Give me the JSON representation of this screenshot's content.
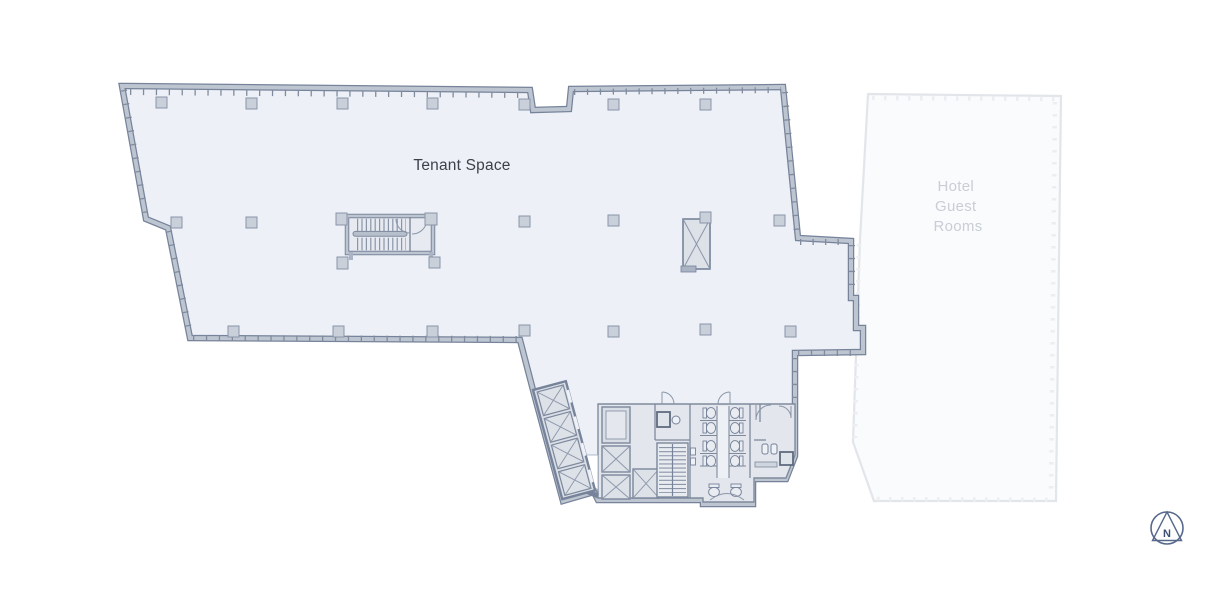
{
  "floorplan": {
    "tenant_area": {
      "label": "Tenant Space"
    },
    "hotel_area": {
      "label_lines": [
        "Hotel",
        "Guest",
        "Rooms"
      ]
    },
    "compass": {
      "letter": "N"
    },
    "features": {
      "central_stair": "stairwell",
      "core": "elevator-and-restroom-core",
      "diagonal_elevator_bank": "4 elevators",
      "core_elevator_bank": "4 elevators",
      "core_stair": "stairwell"
    },
    "colors": {
      "background": "#ffffff",
      "tenant_floor": "#edf1f7",
      "core_floor": "#e3e6ec",
      "wall_edge": "#76839a",
      "wall_fill": "#bdc5d1",
      "column": "#c9d0da",
      "hotel_fill": "#fafbfd",
      "hotel_outline": "#e2e5ea",
      "tenant_label_color": "#3c4149",
      "hotel_label_color": "#c9cdd5",
      "compass_color": "#56688c"
    }
  }
}
